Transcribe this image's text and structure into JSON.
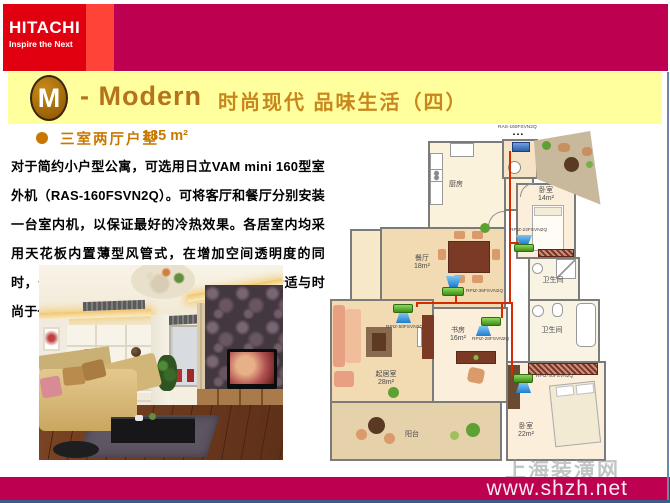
{
  "brand": {
    "logo": "HITACHI",
    "tagline": "Inspire the Next"
  },
  "header": {
    "badge_letter": "M",
    "title_en": "- Modern",
    "title_cn": "时尚现代 品味生活（四）"
  },
  "section": {
    "bullet_heading": "三室两厅户型",
    "area": "135 m²"
  },
  "description": "对于简约小户型公寓，可选用日立VAM mini 160型室外机（RAS-160FSVN2Q）。可将客厅和餐厅分别安装一台室内机，以保证最好的冷热效果。各居室内均采用天花板内置薄型风管式，在增加空间透明度的同时，也保证了各个房间的装潢效果，融简约舒适与时尚于一体。",
  "floorplan": {
    "outdoor_unit_label": "RAS-160FSVN2Q",
    "outdoor_arrows": "▲▲▲",
    "rooms": [
      {
        "name": "厨房",
        "area": ""
      },
      {
        "name": "卧室",
        "area": "14m²"
      },
      {
        "name": "餐厅",
        "area": "18m²"
      },
      {
        "name": "卫生间",
        "area": ""
      },
      {
        "name": "起居室",
        "area": "28m²"
      },
      {
        "name": "书房",
        "area": "16m²"
      },
      {
        "name": "卫生间",
        "area": ""
      },
      {
        "name": "卧室",
        "area": "22m²"
      },
      {
        "name": "阳台",
        "area": ""
      }
    ],
    "units": [
      {
        "label": "RPIZ-22FSVN2Q"
      },
      {
        "label": "RPIZ-36FSVN2Q"
      },
      {
        "label": "RPIZ-50FSVN2Q"
      },
      {
        "label": "RPIZ-28FSVN2Q"
      },
      {
        "label": "RPIZ-40FSVN2Q"
      }
    ]
  },
  "watermark": "上海装潢网",
  "footer": {
    "url": "www.shzh.net"
  },
  "colors": {
    "brand_red": "#E1000F",
    "magenta": "#BE0051",
    "band_yellow": "#FFFF9E",
    "gold": "#C8861C",
    "unit_green": "#56B32A",
    "pipe_red": "#D42B00"
  }
}
